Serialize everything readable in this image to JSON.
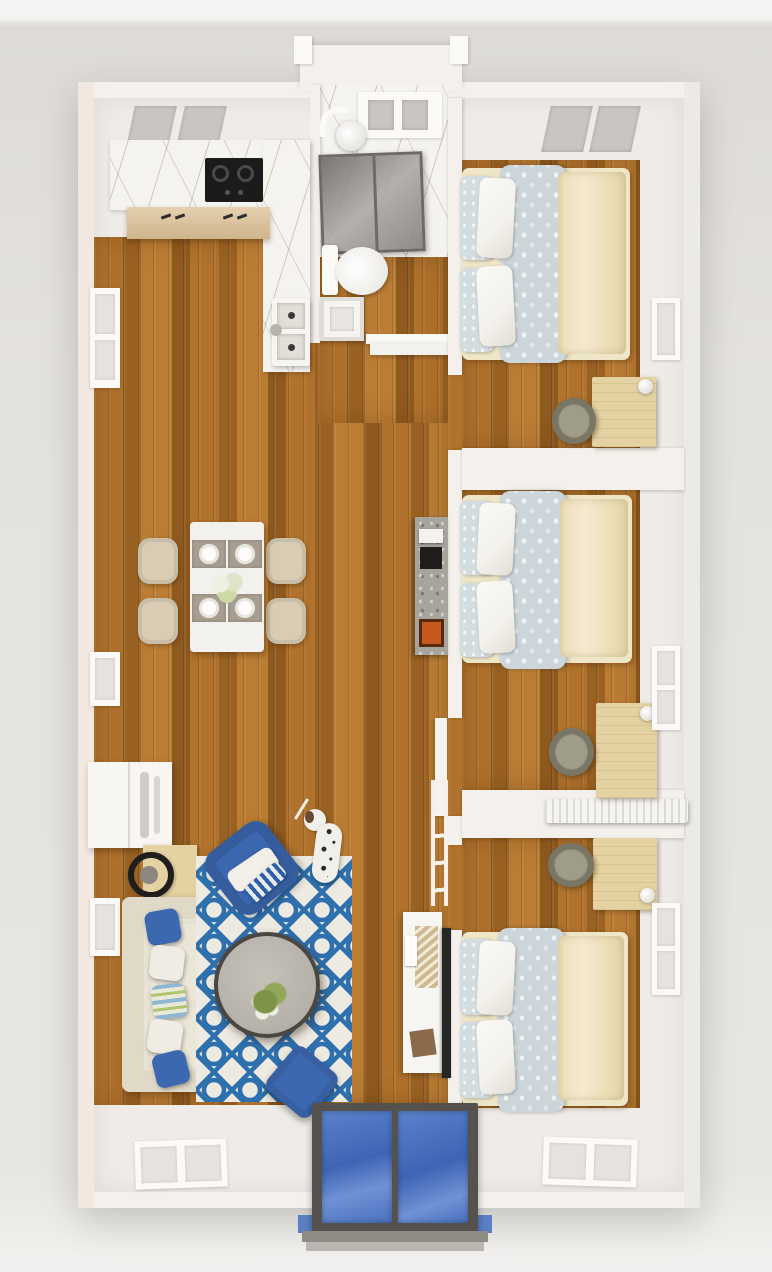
{
  "meta": {
    "title": "Top-down 3D floor plan render of a three-bedroom apartment",
    "view": "top-down 3D dollhouse render",
    "counts": {
      "bedrooms": 3,
      "beds": 3,
      "desks": 3,
      "dining_chairs": 4,
      "sofa_pillows": 5,
      "windows_right_wall": 3,
      "windows_left_wall": 3
    }
  },
  "rooms": {
    "kitchen": {
      "label": "Kitchen",
      "items": [
        "upper cabinets with glass panels",
        "marble L-counter",
        "black two-burner cooktop",
        "light wood base cabinets",
        "white double sink with faucet"
      ]
    },
    "bathroom": {
      "label": "Bathroom",
      "items": [
        "marble floor",
        "window shelf",
        "shower head",
        "glass shower enclosure",
        "toilet",
        "vanity sink",
        "open door"
      ]
    },
    "dining_area": {
      "label": "Dining area",
      "items": [
        "white dining table",
        "four cream chairs",
        "four place settings",
        "white flower centerpiece"
      ]
    },
    "living_room": {
      "label": "Living room",
      "items": [
        "cream sofa",
        "blue and patterned throw pillows",
        "white wall cabinet",
        "wood side table",
        "black ring decor",
        "blue armchair",
        "blue trellis rug",
        "round stone coffee table",
        "plant centerpiece",
        "blue ottoman",
        "dalmatian dog",
        "marble console",
        "white tv console",
        "wall-mounted tv",
        "ladder shelf"
      ]
    },
    "bedroom_1": {
      "label": "Bedroom 1 (top right)",
      "items": [
        "double bed",
        "floral duvet",
        "cream blanket",
        "pillows",
        "desk",
        "chair",
        "lamp",
        "top window",
        "side window"
      ]
    },
    "bedroom_2": {
      "label": "Bedroom 2 (middle right)",
      "items": [
        "double bed",
        "floral duvet",
        "cream blanket",
        "pillows",
        "desk",
        "chair",
        "lamp",
        "side window",
        "radiator shelf",
        "open door"
      ]
    },
    "bedroom_3": {
      "label": "Bedroom 3 (bottom right)",
      "items": [
        "double bed",
        "floral duvet",
        "cream blanket",
        "pillows",
        "desk",
        "chair",
        "lamp",
        "side window",
        "bottom window"
      ]
    },
    "entry": {
      "label": "Entry",
      "items": [
        "blue glass double front door",
        "dark frame",
        "porch steps"
      ]
    }
  },
  "colors": {
    "bg": "#e4e2de",
    "bg_band": "#f4f3f1",
    "wall": "#f4f1ed",
    "wall_left": "#f3e8e0",
    "wall_right": "#eceae6",
    "floor_white": "#efece7",
    "wood_1": "#b0722c",
    "wood_2": "#9a6222",
    "wood_3": "#bb7d34",
    "wood_4": "#8f5a1f",
    "marble": "#f5f3ef",
    "vein": "#6e5f46",
    "cabinet_wood": "#dcc094",
    "cooktop": "#1b1b1b",
    "glass_gray": "#8f8c88",
    "shower_frame": "#6e6b67",
    "bed_blanket": "#eddfb8",
    "bed_duvet": "#ccd5d9",
    "pillow_white": "#f3f1ec",
    "pillow_floral": "#d3dcdf",
    "desk_wood": "#e4d2a2",
    "chair_olive": "#8e8a77",
    "rug_base": "#edeae1",
    "rug_blue": "#2e6fad",
    "sofa": "#e9e3d5",
    "sofa_arm": "#e0d9c8",
    "accent_blue": "#3c68b0",
    "table_white": "#f3f1ed",
    "dining_chair": "#d8cdb4",
    "placemat": "#a79d90",
    "coffee_table": "#b5b1a9",
    "coffee_rim": "#4a4641",
    "door_frame": "#55524d",
    "door_glass_1": "#5a82cc",
    "door_glass_2": "#3f64b4",
    "tv_black": "#262624",
    "radiator": "#f6f4f0",
    "dog_white": "#f1efe9",
    "dog_spot": "#2b2a28",
    "plant_green": "#7d9347",
    "flower_white": "#eef0e2",
    "book_orange": "#c45a1e",
    "wood_box": "#8a6a4a",
    "console_marble": "#a7a39d"
  }
}
